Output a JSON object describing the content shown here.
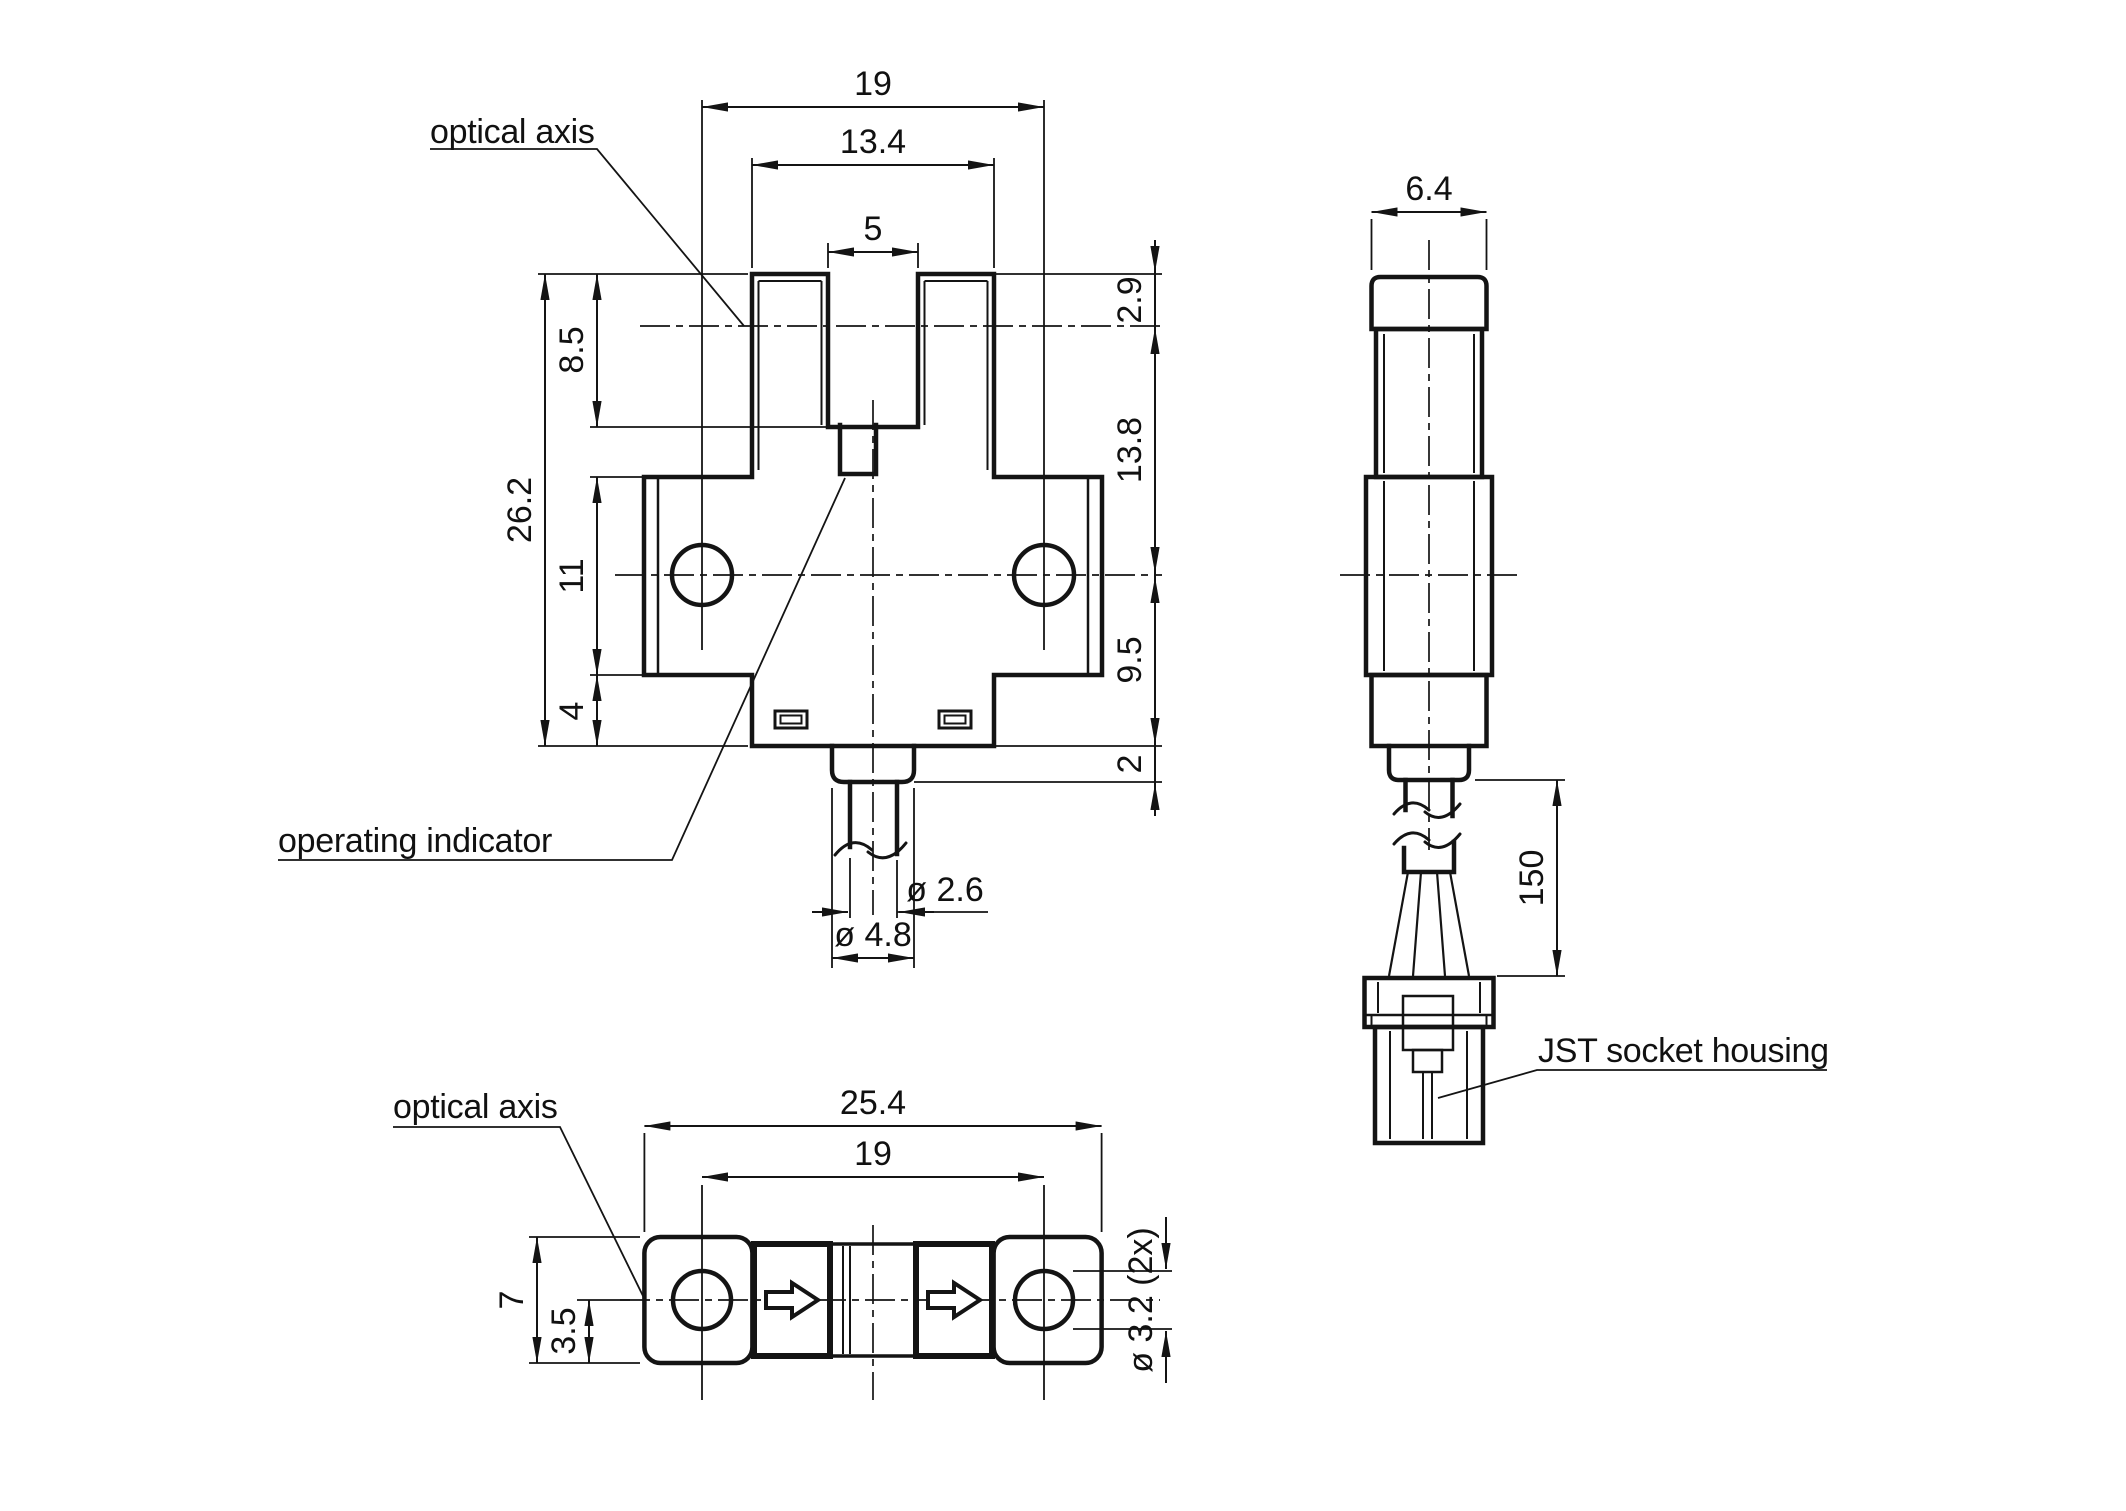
{
  "labels": {
    "optical_axis_top": "optical axis",
    "optical_axis_bottom": "optical axis",
    "operating_indicator": "operating indicator",
    "jst": "JST socket housing"
  },
  "front": {
    "d19": "19",
    "d134": "13.4",
    "d5": "5",
    "d85": "8.5",
    "d262": "26.2",
    "d11": "11",
    "d4": "4",
    "d29": "2.9",
    "d138": "13.8",
    "d95": "9.5",
    "d2": "2",
    "dia26": "ø 2.6",
    "dia48": "ø 4.8"
  },
  "side": {
    "d64": "6.4",
    "d150": "150"
  },
  "bottom": {
    "d254": "25.4",
    "d19": "19",
    "d7": "7",
    "d35": "3.5",
    "dia32": "ø 3.2 (2x)"
  }
}
